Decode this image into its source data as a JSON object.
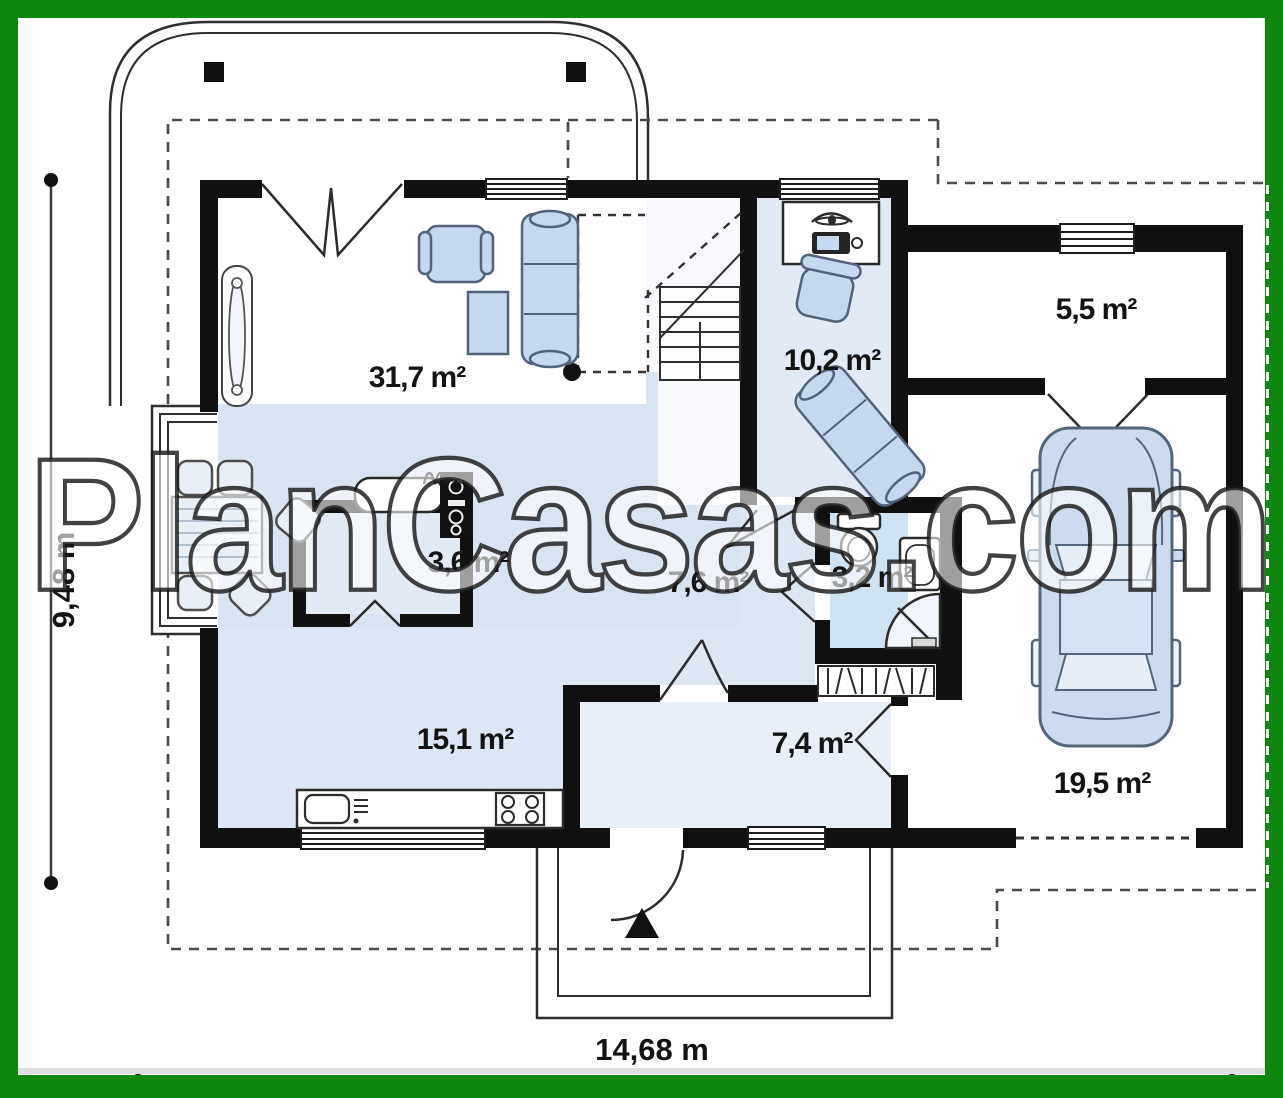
{
  "plan": {
    "watermark": "PlanCasas.com",
    "dimensions": {
      "horizontal": "14,68 m",
      "vertical": "9,48 m"
    },
    "rooms": [
      {
        "id": "living-room",
        "label": "31,7 m²"
      },
      {
        "id": "office-room",
        "label": "10,2 m²"
      },
      {
        "id": "storage-room",
        "label": "5,5 m²"
      },
      {
        "id": "pantry",
        "label": "3,6 m²"
      },
      {
        "id": "hall",
        "label": "7,6 m²"
      },
      {
        "id": "bathroom",
        "label": "3,2 m²"
      },
      {
        "id": "kitchen",
        "label": "15,1 m²"
      },
      {
        "id": "vestibule",
        "label": "7,4 m²"
      },
      {
        "id": "garage",
        "label": "19,5 m²"
      }
    ],
    "icons": [
      "car-icon",
      "sofa-icon",
      "armchair-icon",
      "coffee-table-icon",
      "dining-table-icon",
      "dining-chair-icon",
      "stairs-icon",
      "desk-icon",
      "laptop-icon",
      "office-chair-icon",
      "office-sofa-icon",
      "toilet-icon",
      "sink-icon",
      "shower-icon",
      "cooktop-icon",
      "kitchen-sink-icon",
      "oven-icon",
      "radiator-icon",
      "entrance-arrow-icon"
    ],
    "colors": {
      "frame_green": "#0e870e",
      "wall_black": "#101010",
      "floor_blue": "#d9e4f3",
      "furniture_blue": "#c5d8ee",
      "watermark_fill": "#ffffff"
    }
  }
}
